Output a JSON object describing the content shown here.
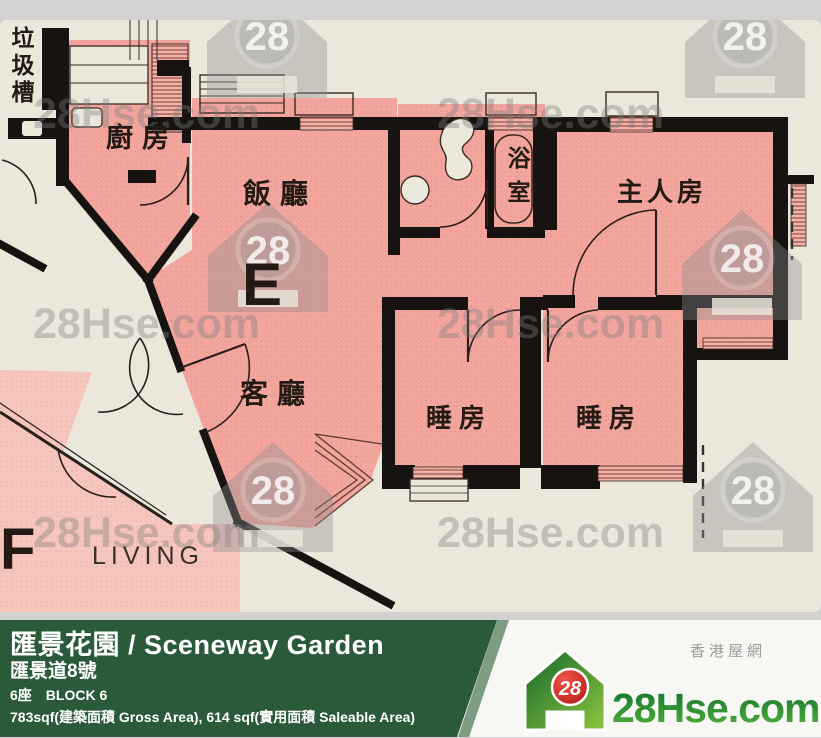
{
  "watermark": {
    "text": "28Hse.com",
    "badge": "28"
  },
  "rooms": {
    "trash_chute": "垃圾槽",
    "kitchen": "廚房",
    "dining": "飯廳",
    "bathroom": "浴室",
    "master_bedroom": "主人房",
    "living": "客廳",
    "bedroom1": "睡房",
    "bedroom2": "睡房",
    "unit_e": "E",
    "unit_f": "F",
    "living_en": "LIVING"
  },
  "footer": {
    "title": "匯景花園 / Sceneway Garden",
    "address": "匯景道8號",
    "block_zh": "6座",
    "block_en": "BLOCK 6",
    "area": "783sqf(建築面積 Gross Area), 614 sqf(實用面積 Saleable Area)",
    "logo": {
      "badge": "28",
      "name": "28Hse.com",
      "tagline": "香港屋網"
    }
  }
}
